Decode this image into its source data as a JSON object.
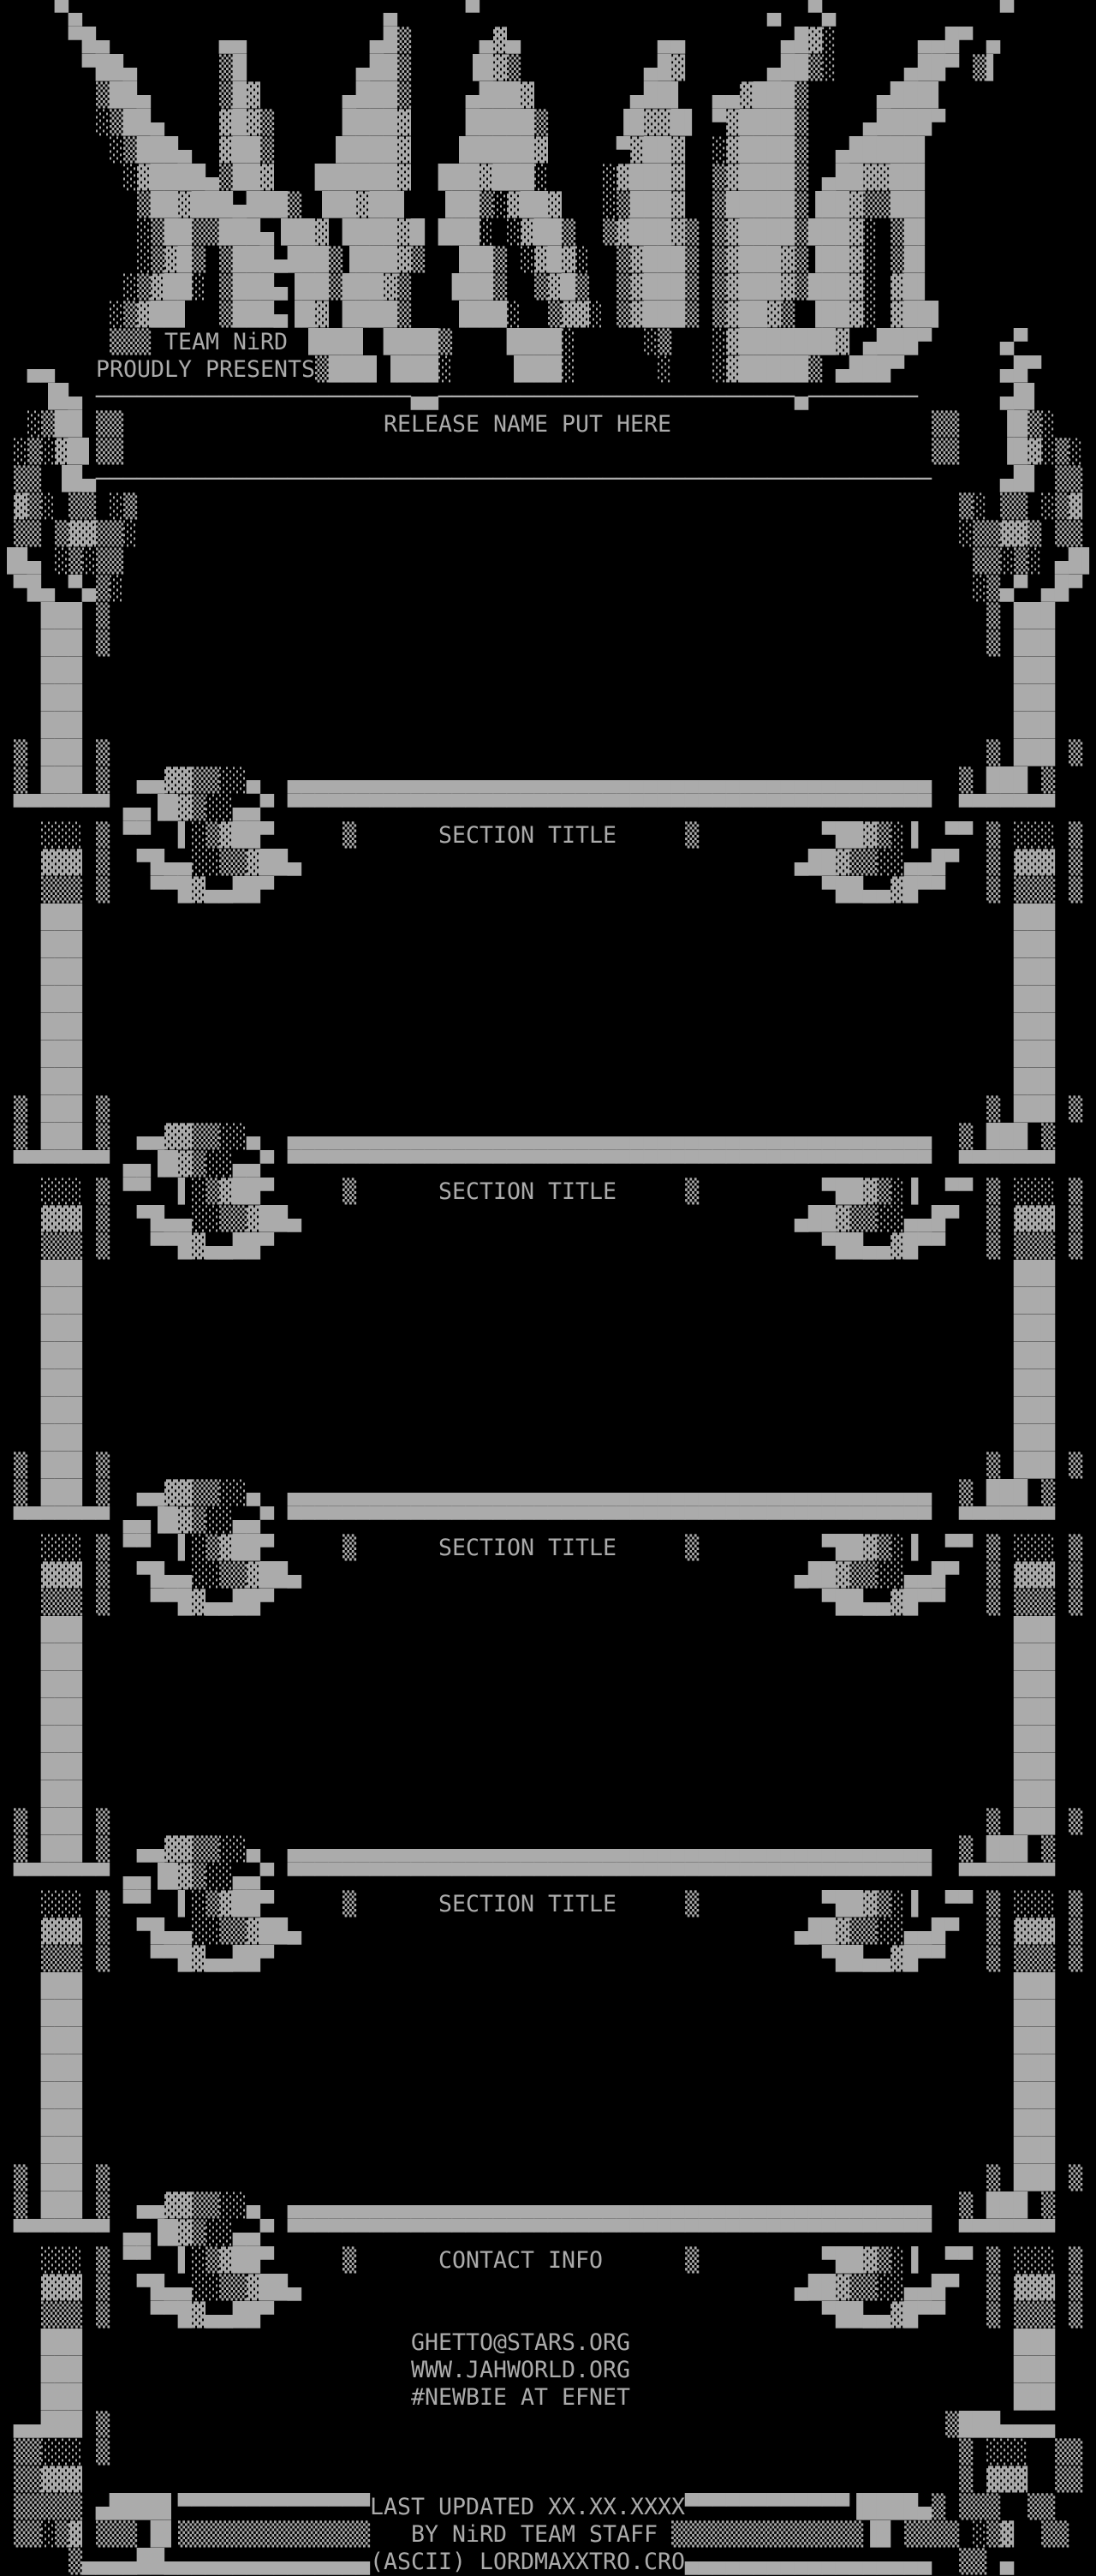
{
  "page": {
    "background": "#000000",
    "foreground": "#ababab"
  },
  "logo": {
    "text": "NiRD"
  },
  "header": {
    "team": "TEAM NiRD",
    "presents": "PROUDLY PRESENTS",
    "release_name": "RELEASE NAME PUT HERE"
  },
  "sections": [
    {
      "title": "SECTION TITLE"
    },
    {
      "title": "SECTION TITLE"
    },
    {
      "title": "SECTION TITLE"
    },
    {
      "title": "SECTION TITLE"
    }
  ],
  "contact": {
    "title": "CONTACT INFO",
    "email": "GHETTO@STARS.ORG",
    "website": "WWW.JAHWORLD.ORG",
    "irc": "#NEWBIE AT EFNET"
  },
  "footer": {
    "last_updated": "LAST UPDATED XX.XX.XXXX",
    "credit": "BY NiRD TEAM STAFF",
    "ascii_credit": "(ASCII) LORDMAXXTRO.CRO"
  },
  "art": {
    "rows": [
      "    ▀▄                      ▄     ▀                     ▄  ▀▄            ▀      ",
      "     ▀█▄        ▄▄         ▄█▒     ▄▓▄          ▄▄       ▄█▓░      ▄▄█▀ ▄       ",
      "      ▀██▄      ▒█        ▄██▒    ▐█▓▒         ▄█▓      ▄██▒░     ▄██▀ ▒▌       ",
      "       ▒██▄     ▒█▓      ▄███▒    ▄███▓       ▄██▌  ▄▄▓███▒     ▄███▌           ",
      "       ░▒██▄    ▓█▓▒     ████▓    █████▒     ▐█▓▓█▌ ▀▓████▒    ▄████▀           ",
      "        ░▒███▄  ▓██▒    ▐████▓   ▐█████▓     ▀▓██▓  ░▓████▒  ▄█████▌            ",
      "         ░▓████▄▒██▓   ██████▓  ███▓███░    ░▓███▓  ▒▓████▒ ▄██▓▓██▌            ",
      "          ▒██▓███▄███▒ ▐██▓██▌  ▐██▒░▓██▓   ░▒███▓  ▒█████▒▐██▓▒▒██▌            ",
      "          ░▒██▒▒███▄▐██▓ ████▓█ ███░ ░▓██▒  ▒▓███▓▒ ▒▓████▒███▓░ ▒█▌            ",
      "          ░▒▓█▒ ▒███▄███▒▐███▓▒  ▐██▒ ░▓█▓░  ▒▓███▒ ▒▓███▓▒▐██▓░ ▒█▌            ",
      "         ░▒▓██░ ▒███▄▐██▒███▓▒   ███▒  ▒▓█▒  ▒▓███▒ ▒▓███▓▒███▓░ ▓█▌            ",
      "        ░▒▓██▌  ▒███▄▐█▓ ████▒   ▐███░  ▒▓▓░ ▒▓███▒ ▒▓██▓▒ ▐██▓░ ▓██▌           ",
      "        ▒▒▒           ▐███▌ ████▒    ████░     ░▒   ░▓███████▓ ▄███▀     ▄▀     ",
      "  ▄▄                   ▒███▌▐███░    ▐███░      ░   ░▓█████▒ ▄███▀       ▄█▀    ",
      "   ▐█▄ ───────────────────────▄▄──────────────────────────▄────────      ▄█▌    ",
      "  ░▒██ ▒▒                                                           ▒▒   ▐█▒░   ",
      " ░▒░▓█▌▒▒                                                           ▒▒   ▐█▓░▒░ ",
      " ▒▒ ▐█▄─────────────────────────────────────────────────────────────     ▄█▌ ▒▒ ",
      " ▓▒░ ▒▒ ░▒                                                            ▒░ ▒▒ ░▒▓ ",
      " ▒▒ ▒▓▓▒▒░                                                            ░▒▒▓▓▒ ▒▒ ",
      "▐█▄ ░▒░▒▒                                                              ▒▒░▒░ ▄█▌",
      " ▀█▄ ▀▄▒░                                                              ░▒▄▀ ▄█▀ ",
      "   ███ ▒                                                                ▒ ███   ",
      "   ███ ▒                                                                ▒ ███   ",
      "   ███                                                                    ███   ",
      "   ███                                                                    ███   ",
      "   ███                                                                    ███   ",
      " ▒ ███ ▒                                                                ▒ ███ ▒ ",
      " ▒ ███ ▒  ▄▄▓▓▒▒░░▄  ▄▄▄▄▄▄▄▄▄▄▄▄▄▄▄▄▄▄▄▄▄▄▄▄▄▄▄▄▄▄▄▄▄▄▄▄▄▄▄▄▄▄▄▄▄▄▄  ▒ ███ ▒ ",
      " ▀▀▀▀▀▀▀ ▄▄▐█▓▒░░▄▄▀ ▀▀▀▀▀▀▀▀▀▀▀▀▀▀▀▀▀▀▀▀▀▀▀▀▀▀▀▀▀▀▀▀▀▀▀▀▀▀▀▀▀▀▀▀▀▀▀  ▀▀▀▀▀▀▀ ",
      "   ░░░ ▒ ▀▀  ▌░▒▓██▀     ▒                        ▒         ▀██▓▒░▐  ▀▀ ▒ ░░░ ▒ ",
      "   ▓▓▓ ▒  ▀█▄▄░░▒▒▓██▄                                    ▄██▓▒▒░░▄▄█▀  ▒ ▓▓▓ ▒ ",
      "   ▒▒▒ ▒   ▀▀█▓▄▄██▀                                        ▀██▄▄▓█▀▀   ▒ ▒▒▒ ▒ ",
      "   ███                                                                    ███   ",
      "   ███                                                                    ███   ",
      "   ███                                                                    ███   ",
      "   ███                                                                    ███   ",
      "   ███                                                                    ███   ",
      "   ███                                                                    ███   ",
      "   ███                                                                    ███   ",
      " ▒ ███ ▒                                                                ▒ ███ ▒ ",
      " ▒ ███ ▒  ▄▄▓▓▒▒░░▄  ▄▄▄▄▄▄▄▄▄▄▄▄▄▄▄▄▄▄▄▄▄▄▄▄▄▄▄▄▄▄▄▄▄▄▄▄▄▄▄▄▄▄▄▄▄▄▄  ▒ ███ ▒ ",
      " ▀▀▀▀▀▀▀ ▄▄▐█▓▒░░▄▄▀ ▀▀▀▀▀▀▀▀▀▀▀▀▀▀▀▀▀▀▀▀▀▀▀▀▀▀▀▀▀▀▀▀▀▀▀▀▀▀▀▀▀▀▀▀▀▀▀  ▀▀▀▀▀▀▀ ",
      "   ░░░ ▒ ▀▀  ▌░▒▓██▀     ▒                        ▒         ▀██▓▒░▐  ▀▀ ▒ ░░░ ▒ ",
      "   ▓▓▓ ▒  ▀█▄▄░░▒▒▓██▄                                    ▄██▓▒▒░░▄▄█▀  ▒ ▓▓▓ ▒ ",
      "   ▒▒▒ ▒   ▀▀█▓▄▄██▀                                        ▀██▄▄▓█▀▀   ▒ ▒▒▒ ▒ ",
      "   ███                                                                    ███   ",
      "   ███                                                                    ███   ",
      "   ███                                                                    ███   ",
      "   ███                                                                    ███   ",
      "   ███                                                                    ███   ",
      "   ███                                                                    ███   ",
      "   ███                                                                    ███   ",
      " ▒ ███ ▒                                                                ▒ ███ ▒ ",
      " ▒ ███ ▒  ▄▄▓▓▒▒░░▄  ▄▄▄▄▄▄▄▄▄▄▄▄▄▄▄▄▄▄▄▄▄▄▄▄▄▄▄▄▄▄▄▄▄▄▄▄▄▄▄▄▄▄▄▄▄▄▄  ▒ ███ ▒ ",
      " ▀▀▀▀▀▀▀ ▄▄▐█▓▒░░▄▄▀ ▀▀▀▀▀▀▀▀▀▀▀▀▀▀▀▀▀▀▀▀▀▀▀▀▀▀▀▀▀▀▀▀▀▀▀▀▀▀▀▀▀▀▀▀▀▀▀  ▀▀▀▀▀▀▀ ",
      "   ░░░ ▒ ▀▀  ▌░▒▓██▀     ▒                        ▒         ▀██▓▒░▐  ▀▀ ▒ ░░░ ▒ ",
      "   ▓▓▓ ▒  ▀█▄▄░░▒▒▓██▄                                    ▄██▓▒▒░░▄▄█▀  ▒ ▓▓▓ ▒ ",
      "   ▒▒▒ ▒   ▀▀█▓▄▄██▀                                        ▀██▄▄▓█▀▀   ▒ ▒▒▒ ▒ ",
      "   ███                                                                    ███   ",
      "   ███                                                                    ███   ",
      "   ███                                                                    ███   ",
      "   ███                                                                    ███   ",
      "   ███                                                                    ███   ",
      "   ███                                                                    ███   ",
      "   ███                                                                    ███   ",
      " ▒ ███ ▒                                                                ▒ ███ ▒ ",
      " ▒ ███ ▒  ▄▄▓▓▒▒░░▄  ▄▄▄▄▄▄▄▄▄▄▄▄▄▄▄▄▄▄▄▄▄▄▄▄▄▄▄▄▄▄▄▄▄▄▄▄▄▄▄▄▄▄▄▄▄▄▄  ▒ ███ ▒ ",
      " ▀▀▀▀▀▀▀ ▄▄▐█▓▒░░▄▄▀ ▀▀▀▀▀▀▀▀▀▀▀▀▀▀▀▀▀▀▀▀▀▀▀▀▀▀▀▀▀▀▀▀▀▀▀▀▀▀▀▀▀▀▀▀▀▀▀  ▀▀▀▀▀▀▀ ",
      "   ░░░ ▒ ▀▀  ▌░▒▓██▀     ▒                        ▒         ▀██▓▒░▐  ▀▀ ▒ ░░░ ▒ ",
      "   ▓▓▓ ▒  ▀█▄▄░░▒▒▓██▄                                    ▄██▓▒▒░░▄▄█▀  ▒ ▓▓▓ ▒ ",
      "   ▒▒▒ ▒   ▀▀█▓▄▄██▀                                        ▀██▄▄▓█▀▀   ▒ ▒▒▒ ▒ ",
      "   ███                                                                    ███   ",
      "   ███                                                                    ███   ",
      "   ███                                                                    ███   ",
      "   ███                                                                    ███   ",
      "   ███                                                                    ███   ",
      "   ███                                                                    ███   ",
      "   ███                                                                    ███   ",
      " ▒ ███ ▒                                                                ▒ ███ ▒ ",
      " ▒ ███ ▒  ▄▄▓▓▒▒░░▄  ▄▄▄▄▄▄▄▄▄▄▄▄▄▄▄▄▄▄▄▄▄▄▄▄▄▄▄▄▄▄▄▄▄▄▄▄▄▄▄▄▄▄▄▄▄▄▄  ▒ ███ ▒ ",
      " ▀▀▀▀▀▀▀ ▄▄▐█▓▒░░▄▄▀ ▀▀▀▀▀▀▀▀▀▀▀▀▀▀▀▀▀▀▀▀▀▀▀▀▀▀▀▀▀▀▀▀▀▀▀▀▀▀▀▀▀▀▀▀▀▀▀  ▀▀▀▀▀▀▀ ",
      "   ░░░ ▒ ▀▀  ▌░▒▓██▀     ▒                        ▒         ▀██▓▒░▐  ▀▀ ▒ ░░░ ▒ ",
      "   ▓▓▓ ▒  ▀█▄▄░░▒▒▓██▄                                    ▄██▓▒▒░░▄▄█▀  ▒ ▓▓▓ ▒ ",
      "   ▒▒▒ ▒   ▀▀█▓▄▄██▀                                        ▀██▄▄▓█▀▀   ▒ ▒▒▒ ▒ ",
      "   ███                                                                    ███   ",
      "   ███                                                                    ███   ",
      "   ███                                                                    ███   ",
      " ▄▄███ ▒                                                             ▒███▄▄▄▄   ",
      " ▒▒░░░ ▒                                                              ▒ ░░░  ▒▒ ",
      " ▒▒▓▓▓                                                                ▒ ▓▓▓  ▒▒ ",
      " ▒▒▒▒▒ ▄████▌▀▀▀▀▀▀▀▀▀▀▀▀▀▀                       ▀▀▀▀▀▀▀▀▀▀▀▀▐████▄▒ ▒▒▒  ▒▒ ",
      " ▒▒░▒▓ ▒▒▒ █▌▒▒▒▒▒▒▒▒▒▒▒▒▒▒                      ▒▒▒▒▒▒▒▒▒▒▒▒▒▒▐█ ▒▒▒▒ ░▒▓  ▒▒ ",
      "     ▒▄▄▄▄██▄▄▄▄▄▄▄▄▄▄▄▄▄▄▄                       ▄▄▄▄▄▄▄▄▄▄▄▄▄▄▄▄▄▄  ▒▒ ▄      "
    ]
  }
}
